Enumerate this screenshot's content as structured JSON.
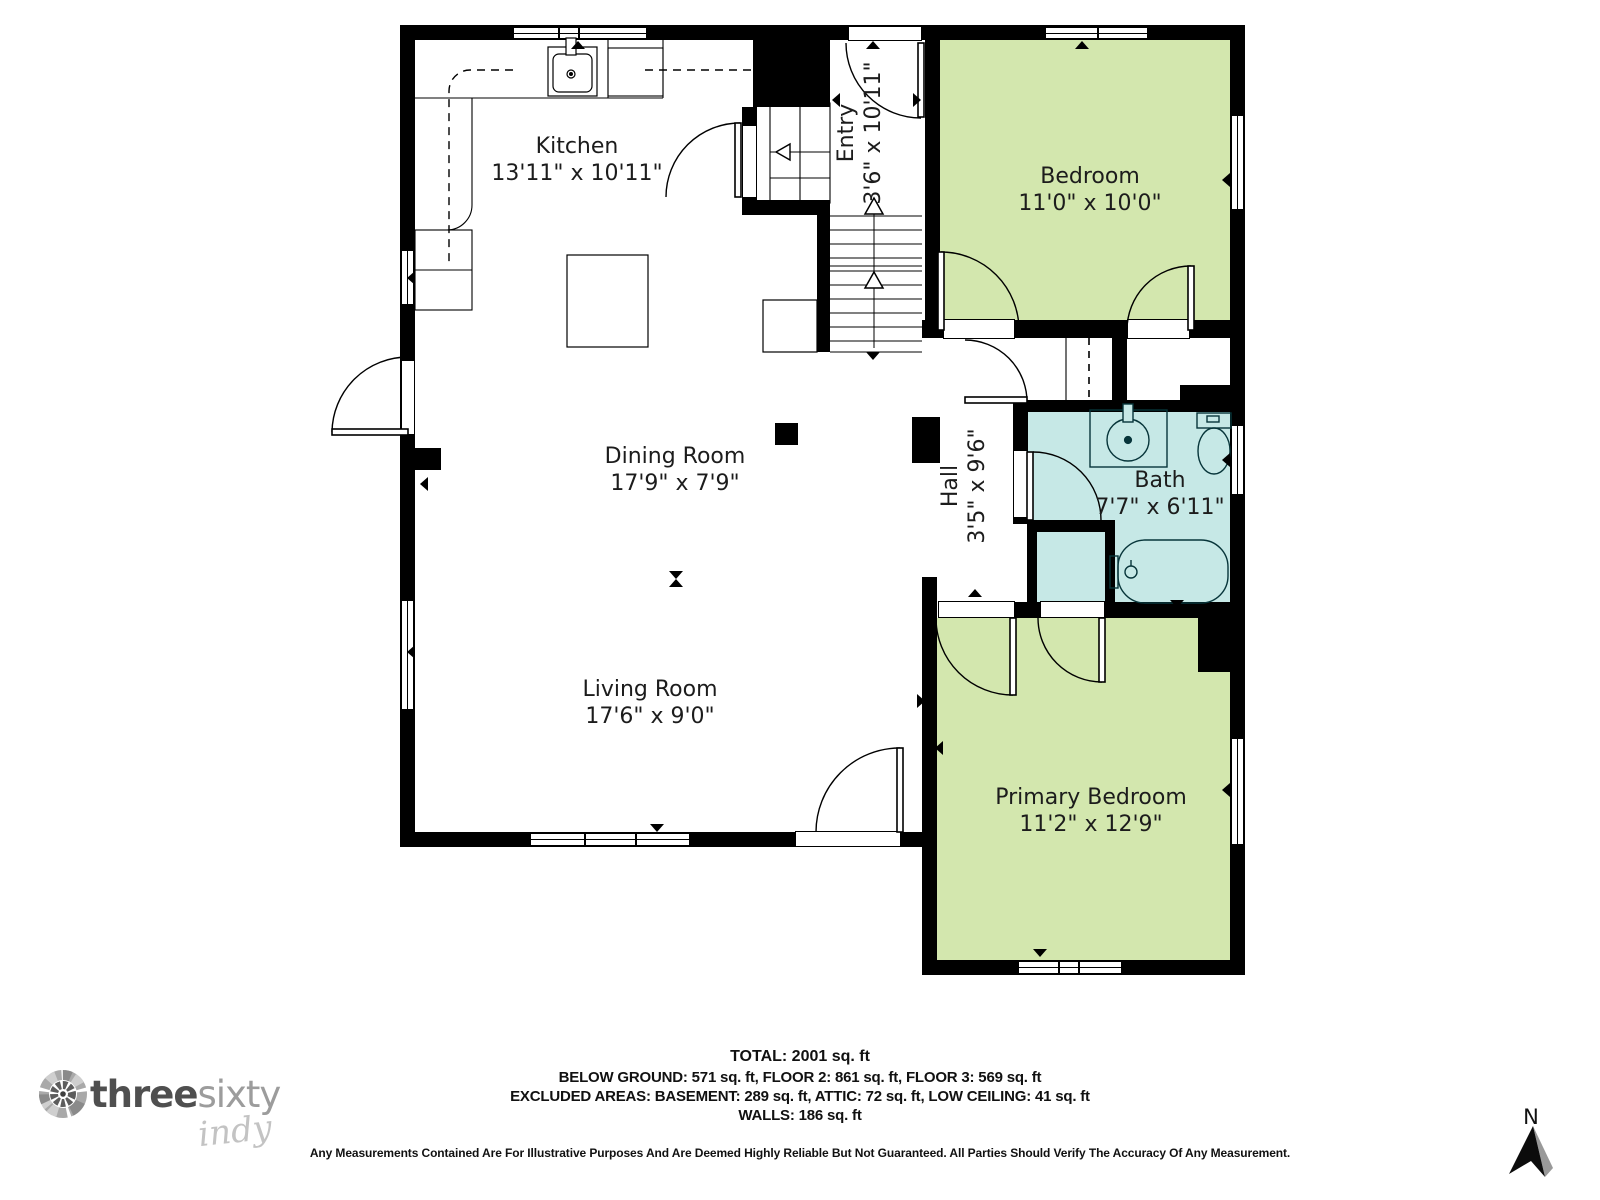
{
  "plan": {
    "rooms": [
      {
        "id": "kitchen",
        "name": "Kitchen",
        "dims": "13'11\" x 10'11\""
      },
      {
        "id": "entry",
        "name": "Entry",
        "dims": "3'6\" x 10'11\""
      },
      {
        "id": "bedroom",
        "name": "Bedroom",
        "dims": "11'0\" x 10'0\""
      },
      {
        "id": "dining",
        "name": "Dining Room",
        "dims": "17'9\" x 7'9\""
      },
      {
        "id": "hall",
        "name": "Hall",
        "dims": "3'5\" x 9'6\""
      },
      {
        "id": "bath",
        "name": "Bath",
        "dims": "7'7\" x 6'11\""
      },
      {
        "id": "living",
        "name": "Living Room",
        "dims": "17'6\" x 9'0\""
      },
      {
        "id": "primary",
        "name": "Primary Bedroom",
        "dims": "11'2\" x 12'9\""
      }
    ],
    "colors": {
      "bedroom_fill": "#d3e7ae",
      "bath_fill": "#c6e8e6",
      "wall": "#000000"
    }
  },
  "footer": {
    "total": "TOTAL: 2001 sq. ft",
    "line1": "BELOW GROUND: 571 sq. ft, FLOOR 2: 861 sq. ft, FLOOR 3: 569 sq. ft",
    "line2": "EXCLUDED AREAS: BASEMENT: 289 sq. ft, ATTIC: 72 sq. ft, LOW CEILING: 41 sq. ft",
    "line3": "WALLS: 186 sq. ft",
    "disclaimer": "Any Measurements Contained Are For Illustrative Purposes And Are Deemed Highly Reliable But Not Guaranteed. All Parties Should Verify The Accuracy Of Any Measurement."
  },
  "logo": {
    "part1": "three",
    "part2": "sixty",
    "part3": "indy"
  },
  "compass": {
    "label": "N"
  }
}
